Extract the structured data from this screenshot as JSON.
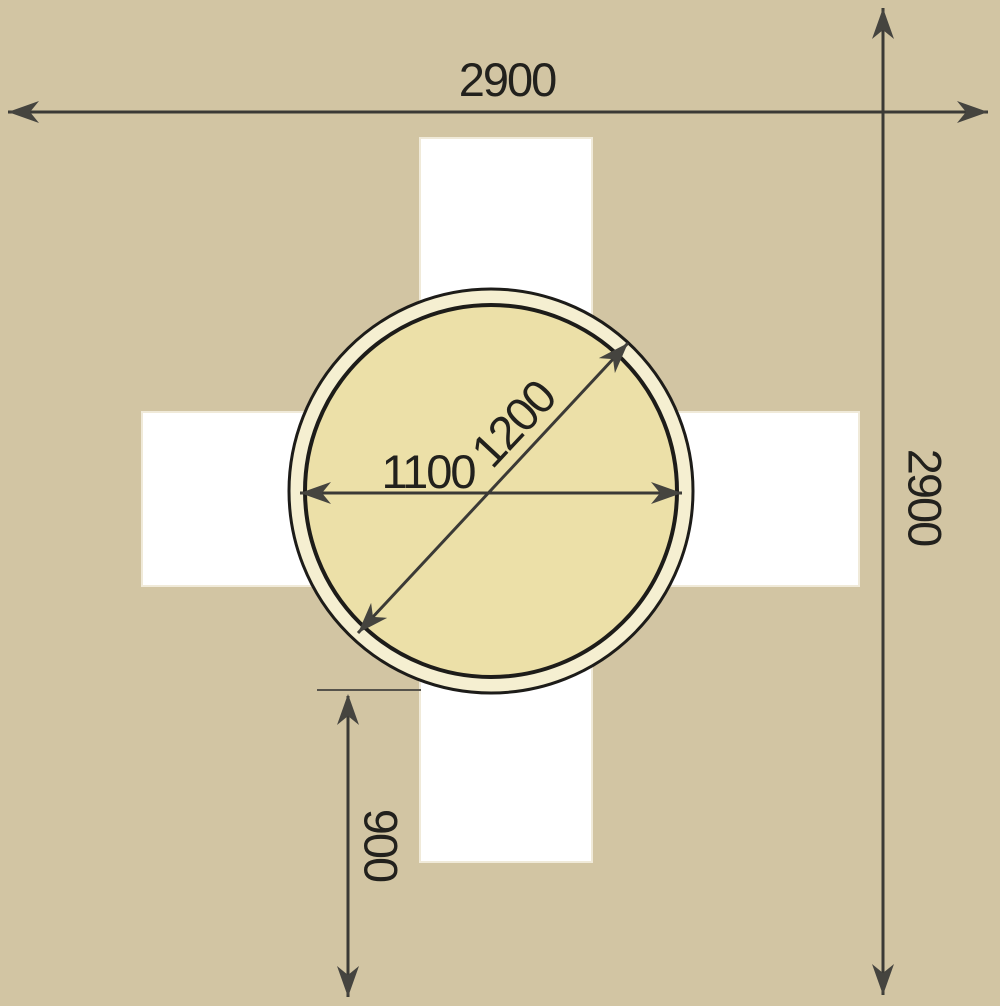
{
  "diagram": {
    "type": "dimensioned-plan-drawing",
    "description_visible_elements": "round table on cross-shaped area with dimension arrows",
    "dimensions": {
      "overall_width": "2900",
      "overall_height": "2900",
      "table_inner_diameter": "1100",
      "table_outer_diameter": "1200",
      "bottom_offset": "900"
    },
    "colors": {
      "background": "#d2c5a3",
      "cross_fill": "#ffffff",
      "cross_edge": "#f0ead9",
      "table_rim_fill": "#f5efd1",
      "table_top_fill": "#ece0a8",
      "circle_stroke": "#1d1c19",
      "dimension_line": "#3b3a36",
      "arrowhead": "#45443f",
      "label_text": "#22211d"
    }
  }
}
